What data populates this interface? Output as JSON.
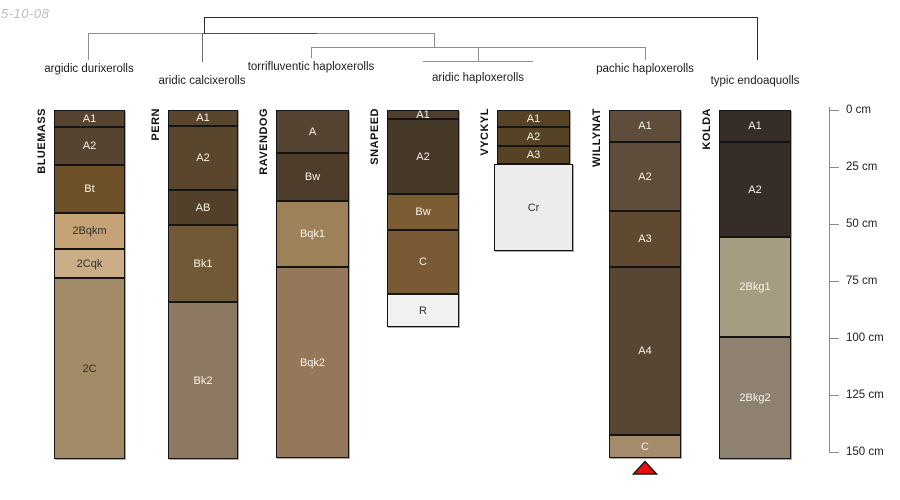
{
  "watermark": "5-10-08",
  "chart_data": {
    "type": "bar",
    "title": "Soil profile horizons by series, grouped by taxonomic classification (dendrogram)",
    "depth_axis": {
      "unit": "cm",
      "min": 0,
      "max": 150,
      "tick_step": 25,
      "tick_labels": [
        "0 cm",
        "25 cm",
        "50 cm",
        "75 cm",
        "100 cm",
        "125 cm",
        "150 cm"
      ]
    },
    "tree": {
      "segments": [
        {
          "x1": 204,
          "y1": 17,
          "x2": 757,
          "y2": 17,
          "color": "#2b2b2b"
        },
        {
          "x1": 204,
          "y1": 17,
          "x2": 204,
          "y2": 33,
          "color": "#2b2b2b"
        },
        {
          "x1": 757,
          "y1": 17,
          "x2": 757,
          "y2": 60,
          "color": "#2b2b2b"
        },
        {
          "x1": 88,
          "y1": 33,
          "x2": 434,
          "y2": 33,
          "color": "#8f8f8f"
        },
        {
          "x1": 202,
          "y1": 33,
          "x2": 317,
          "y2": 33,
          "color": "#4f4f4f"
        },
        {
          "x1": 88,
          "y1": 33,
          "x2": 88,
          "y2": 60,
          "color": "#8f8f8f"
        },
        {
          "x1": 202,
          "y1": 33,
          "x2": 202,
          "y2": 62,
          "color": "#6f6f6f"
        },
        {
          "x1": 434,
          "y1": 33,
          "x2": 434,
          "y2": 47,
          "color": "#8f8f8f"
        },
        {
          "x1": 311,
          "y1": 47,
          "x2": 645,
          "y2": 47,
          "color": "#8f8f8f"
        },
        {
          "x1": 311,
          "y1": 47,
          "x2": 311,
          "y2": 58,
          "color": "#8f8f8f"
        },
        {
          "x1": 478,
          "y1": 47,
          "x2": 478,
          "y2": 61,
          "color": "#8f8f8f"
        },
        {
          "x1": 423,
          "y1": 61,
          "x2": 533,
          "y2": 61,
          "color": "#8f8f8f"
        },
        {
          "x1": 645,
          "y1": 47,
          "x2": 645,
          "y2": 60,
          "color": "#8f8f8f"
        }
      ],
      "group_labels": [
        {
          "label": "argidic durixerolls",
          "x": 89,
          "y": 63
        },
        {
          "label": "aridic calcixerolls",
          "x": 202,
          "y": 75
        },
        {
          "label": "torrifluventic haploxerolls",
          "x": 311,
          "y": 61
        },
        {
          "label": "aridic haploxerolls",
          "x": 478,
          "y": 72
        },
        {
          "label": "pachic haploxerolls",
          "x": 645,
          "y": 63
        },
        {
          "label": "typic endoaquolls",
          "x": 755,
          "y": 75
        }
      ]
    },
    "profiles": [
      {
        "name": "BLUEMASS",
        "taxon": "argidic durixerolls",
        "x": 54,
        "w": 71,
        "horizons": [
          {
            "label": "A1",
            "top_cm": 0,
            "bottom_cm": 7.5,
            "color": "#564430"
          },
          {
            "label": "A2",
            "top_cm": 7.5,
            "bottom_cm": 24,
            "color": "#564430"
          },
          {
            "label": "Bt",
            "top_cm": 24,
            "bottom_cm": 45,
            "color": "#6f5129"
          },
          {
            "label": "2Bqkm",
            "top_cm": 45,
            "bottom_cm": 61,
            "color": "#c6a376",
            "dark_label": true
          },
          {
            "label": "2Cqk",
            "top_cm": 61,
            "bottom_cm": 73.5,
            "color": "#cbae87",
            "dark_label": true
          },
          {
            "label": "2C",
            "top_cm": 73.5,
            "bottom_cm": 153,
            "color": "#a38b68",
            "dark_label": true
          }
        ]
      },
      {
        "name": "PERN",
        "taxon": "aridic calcixerolls",
        "x": 168,
        "w": 70,
        "horizons": [
          {
            "label": "A1",
            "top_cm": 0,
            "bottom_cm": 7,
            "color": "#59462c"
          },
          {
            "label": "A2",
            "top_cm": 7,
            "bottom_cm": 35,
            "color": "#59462c"
          },
          {
            "label": "AB",
            "top_cm": 35,
            "bottom_cm": 50.5,
            "color": "#52402a"
          },
          {
            "label": "Bk1",
            "top_cm": 50.5,
            "bottom_cm": 84,
            "color": "#715936"
          },
          {
            "label": "Bk2",
            "top_cm": 84,
            "bottom_cm": 153,
            "color": "#8d7961"
          }
        ]
      },
      {
        "name": "RAVENDOG",
        "taxon": "torrifluventic haploxerolls",
        "x": 276,
        "w": 73,
        "horizons": [
          {
            "label": "A",
            "top_cm": 0,
            "bottom_cm": 19,
            "color": "#564433"
          },
          {
            "label": "Bw",
            "top_cm": 19,
            "bottom_cm": 40,
            "color": "#4e3d2b"
          },
          {
            "label": "Bqk1",
            "top_cm": 40,
            "bottom_cm": 69,
            "color": "#9d8159"
          },
          {
            "label": "Bqk2",
            "top_cm": 69,
            "bottom_cm": 152.5,
            "color": "#95785a"
          }
        ]
      },
      {
        "name": "SNAPEED",
        "taxon": "aridic haploxerolls",
        "x": 387,
        "w": 72,
        "horizons": [
          {
            "label": "A1",
            "top_cm": 0,
            "bottom_cm": 4,
            "color": "#503f2a"
          },
          {
            "label": "A2",
            "top_cm": 4,
            "bottom_cm": 37,
            "color": "#473928"
          },
          {
            "label": "Bw",
            "top_cm": 37,
            "bottom_cm": 52.5,
            "color": "#7b5c33"
          },
          {
            "label": "C",
            "top_cm": 52.5,
            "bottom_cm": 80.5,
            "color": "#7a5a34"
          },
          {
            "label": "R",
            "top_cm": 80.5,
            "bottom_cm": 95,
            "color": "#f1f1f1",
            "dark_label": true
          }
        ]
      },
      {
        "name": "VYCKYL",
        "taxon": "aridic haploxerolls",
        "x": 497,
        "w": 73,
        "horizons": [
          {
            "label": "A1",
            "top_cm": 0,
            "bottom_cm": 7.5,
            "color": "#564325"
          },
          {
            "label": "A2",
            "top_cm": 7.5,
            "bottom_cm": 16,
            "color": "#564325"
          },
          {
            "label": "A3",
            "top_cm": 16,
            "bottom_cm": 23.5,
            "color": "#564325"
          },
          {
            "label": "Cr",
            "top_cm": 23.5,
            "bottom_cm": 62,
            "color": "#ececec",
            "dark_label": true,
            "extend_px": 3
          }
        ]
      },
      {
        "name": "WILLYNAT",
        "taxon": "pachic haploxerolls",
        "x": 609,
        "w": 72,
        "marker_below": true,
        "horizons": [
          {
            "label": "A1",
            "top_cm": 0,
            "bottom_cm": 14,
            "color": "#5e4d3a"
          },
          {
            "label": "A2",
            "top_cm": 14,
            "bottom_cm": 44.5,
            "color": "#5e4d3a"
          },
          {
            "label": "A3",
            "top_cm": 44.5,
            "bottom_cm": 69,
            "color": "#5f4a31"
          },
          {
            "label": "A4",
            "top_cm": 69,
            "bottom_cm": 142.5,
            "color": "#574732"
          },
          {
            "label": "C",
            "top_cm": 142.5,
            "bottom_cm": 152.5,
            "color": "#a48b6b"
          }
        ]
      },
      {
        "name": "KOLDA",
        "taxon": "typic endoaquolls",
        "x": 719,
        "w": 72,
        "horizons": [
          {
            "label": "A1",
            "top_cm": 0,
            "bottom_cm": 14,
            "color": "#362d26"
          },
          {
            "label": "A2",
            "top_cm": 14,
            "bottom_cm": 55.5,
            "color": "#362d26"
          },
          {
            "label": "2Bkg1",
            "top_cm": 55.5,
            "bottom_cm": 99.5,
            "color": "#a59d82"
          },
          {
            "label": "2Bkg2",
            "top_cm": 99.5,
            "bottom_cm": 153,
            "color": "#8e8170"
          }
        ]
      }
    ],
    "marker": {
      "shape": "triangle-up",
      "fill": "#ea0f0f",
      "stroke": "#1a1a1a"
    },
    "label_colors": {
      "light": "#f7f3ea",
      "dark": "#2e2e2e"
    },
    "layout": {
      "axis_x": 829,
      "axis_y0": 110,
      "px_per_cm": 2.28,
      "tick_len": 10
    }
  }
}
